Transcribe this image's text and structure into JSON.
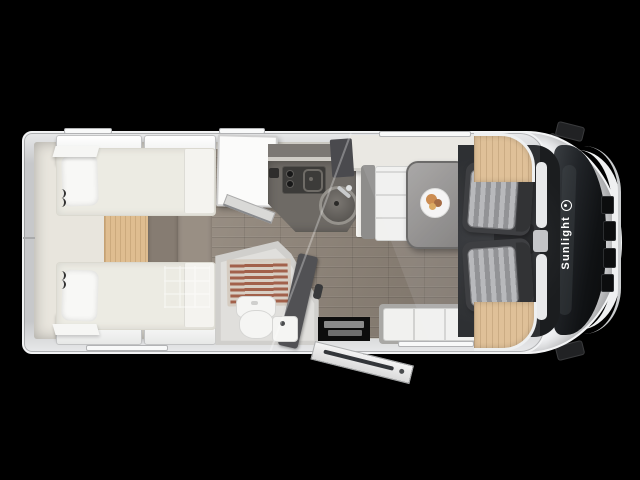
{
  "title": "Sunlight motorhome floor plan, top-down cutaway view",
  "branding": {
    "logo_text": "Sunlight",
    "logo_color": "#ffffff"
  },
  "colors": {
    "background": "#000000",
    "body_white": "#e9eaeb",
    "interior_cream": "#e8e5dd",
    "floor_wood": "#8f8478",
    "birch_wood": "#ddbb8e",
    "kitchen_counter": "#6e6a65",
    "dinette_table": "#8e8c8a",
    "cab_seat_shell": "#2d2e30",
    "seat_stripe_light": "#b3b4b6",
    "bench_cushion": "#f1f1ef",
    "shower_slats": "#a2614b",
    "bathroom_dark_wall": "#515154",
    "windshield_glass": "#17191c",
    "mattress_ivory": "#ecebe3"
  }
}
